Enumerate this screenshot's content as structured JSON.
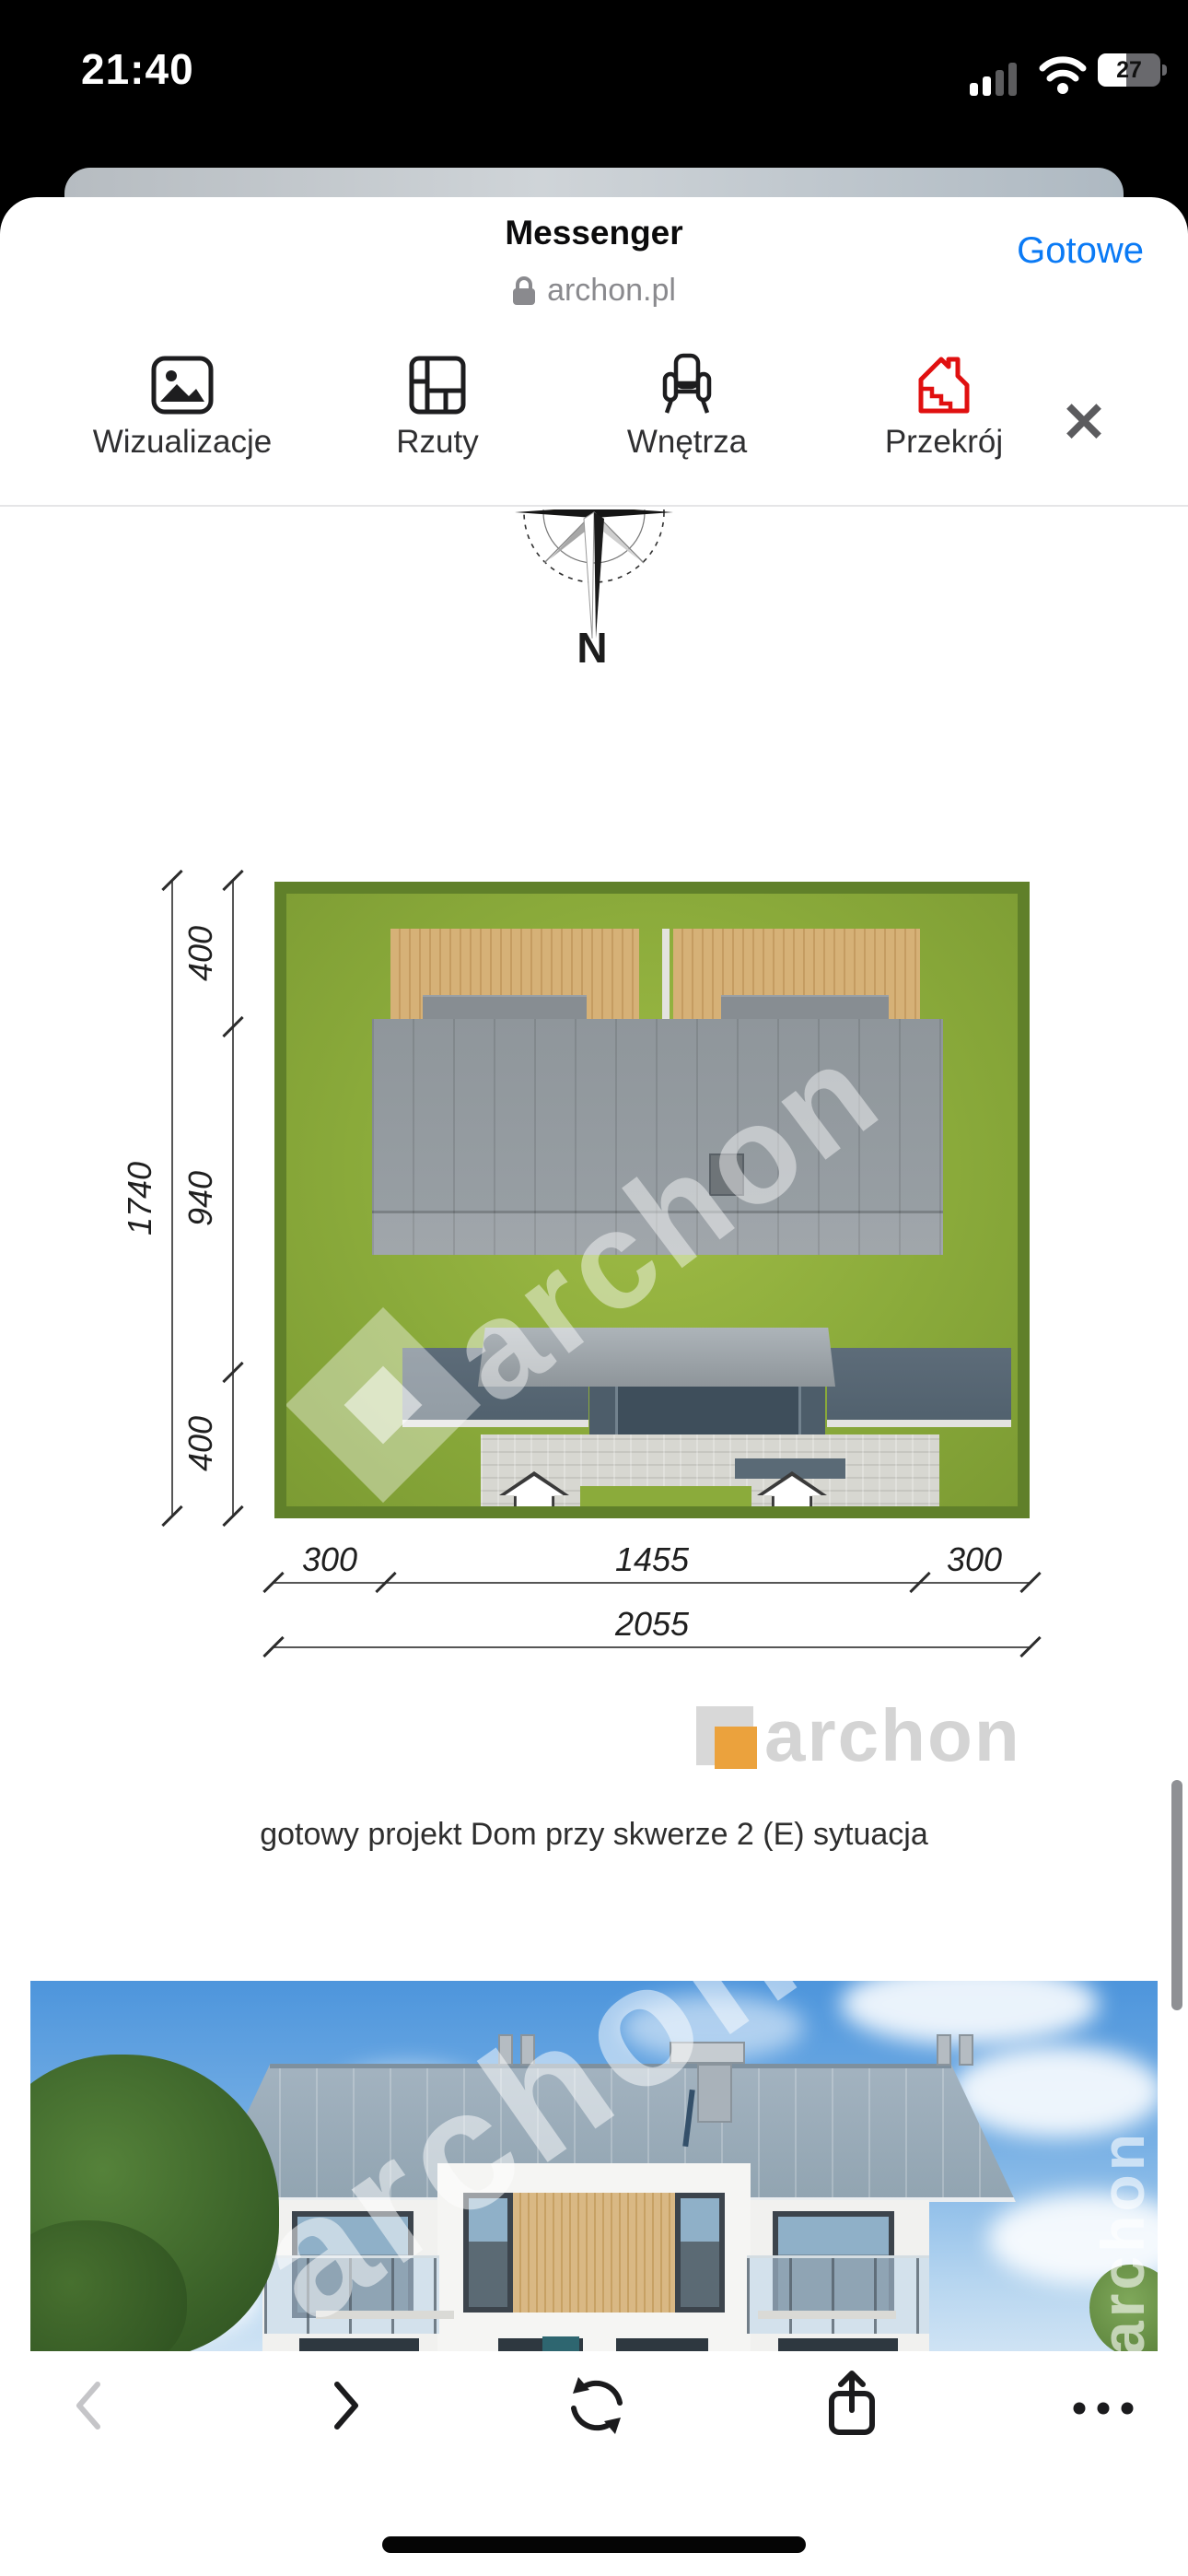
{
  "status_bar": {
    "time": "21:40",
    "battery_percent": "27"
  },
  "sheet_header": {
    "app_title": "Messenger",
    "site_host": "archon.pl",
    "done_label": "Gotowe"
  },
  "tab_bar": {
    "tabs": [
      {
        "label": "Wizualizacje",
        "icon": "gallery-icon"
      },
      {
        "label": "Rzuty",
        "icon": "floorplan-icon"
      },
      {
        "label": "Wnętrza",
        "icon": "armchair-icon"
      },
      {
        "label": "Przekrój",
        "icon": "house-section-icon"
      }
    ],
    "close_label": "✕"
  },
  "compass": {
    "north_label": "N"
  },
  "site_plan": {
    "left_dims": {
      "total": "1740",
      "segments": [
        "400",
        "940",
        "400"
      ]
    },
    "bottom_dims": {
      "segments": [
        "300",
        "1455",
        "300"
      ],
      "total": "2055"
    },
    "watermark": "archon"
  },
  "brand": {
    "logo_text": "archon"
  },
  "caption": {
    "text": "gotowy projekt Dom przy skwerze 2 (E) sytuacja"
  },
  "photo": {
    "watermark_diagonal": "archon",
    "watermark_vertical": "archon"
  },
  "toolbar": {
    "icons": [
      "back",
      "forward",
      "refresh",
      "share",
      "more"
    ]
  },
  "colors": {
    "accent_blue": "#0a7af5",
    "section_icon_red": "#e01010",
    "logo_orange": "#eba23d",
    "lawn_green": "#8bab3b",
    "roof_gray": "#8f969b",
    "wood_tan": "#d6b177",
    "sky_blue": "#4d95dc"
  }
}
